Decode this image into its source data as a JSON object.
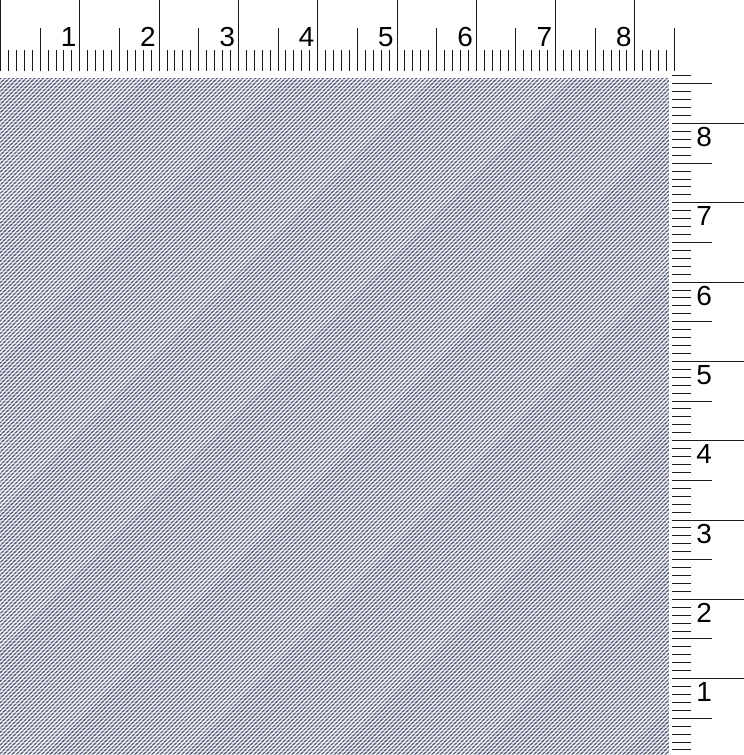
{
  "window": {
    "width_px": 744,
    "height_px": 755,
    "background": "#ffffff"
  },
  "horizontal_ruler": {
    "labels": [
      "1",
      "2",
      "3",
      "4",
      "5",
      "6",
      "7",
      "8"
    ],
    "unit_px": 79.3,
    "minor_per_unit": 10,
    "tick_count": 86,
    "height_px": 78,
    "major_len_px": 71,
    "half_len_px": 43,
    "minor_len_px": 21,
    "tick_color": "#1b1b1b",
    "label_color": "#000000",
    "label_font_px": 28
  },
  "vertical_ruler": {
    "labels": [
      "8",
      "7",
      "6",
      "5",
      "4",
      "3",
      "2",
      "1"
    ],
    "unit_px": 79.3,
    "minor_per_unit": 10,
    "origin_y_px": 123,
    "left_px": 672,
    "width_px": 72,
    "first_minor_index": -6,
    "last_minor_index": 79,
    "major_len_px": 72,
    "half_len_px": 40,
    "minor_len_px": 19,
    "tick_color": "#1b1b1b",
    "label_color": "#000000",
    "label_font_px": 28,
    "label_left_px": 693
  },
  "canvas": {
    "x_px": 0,
    "y_px": 78,
    "width_px": 669,
    "height_px": 677,
    "weave": {
      "type": "diagonal-twill",
      "stripe_direction": "bottom-left-to-top-right",
      "angle_deg": 135,
      "period_px": 3,
      "dark_color": "#575c7c",
      "mid_color": "#9ca1b8",
      "light_color": "#ffffff",
      "row_highlight_alpha": 0.45
    }
  }
}
